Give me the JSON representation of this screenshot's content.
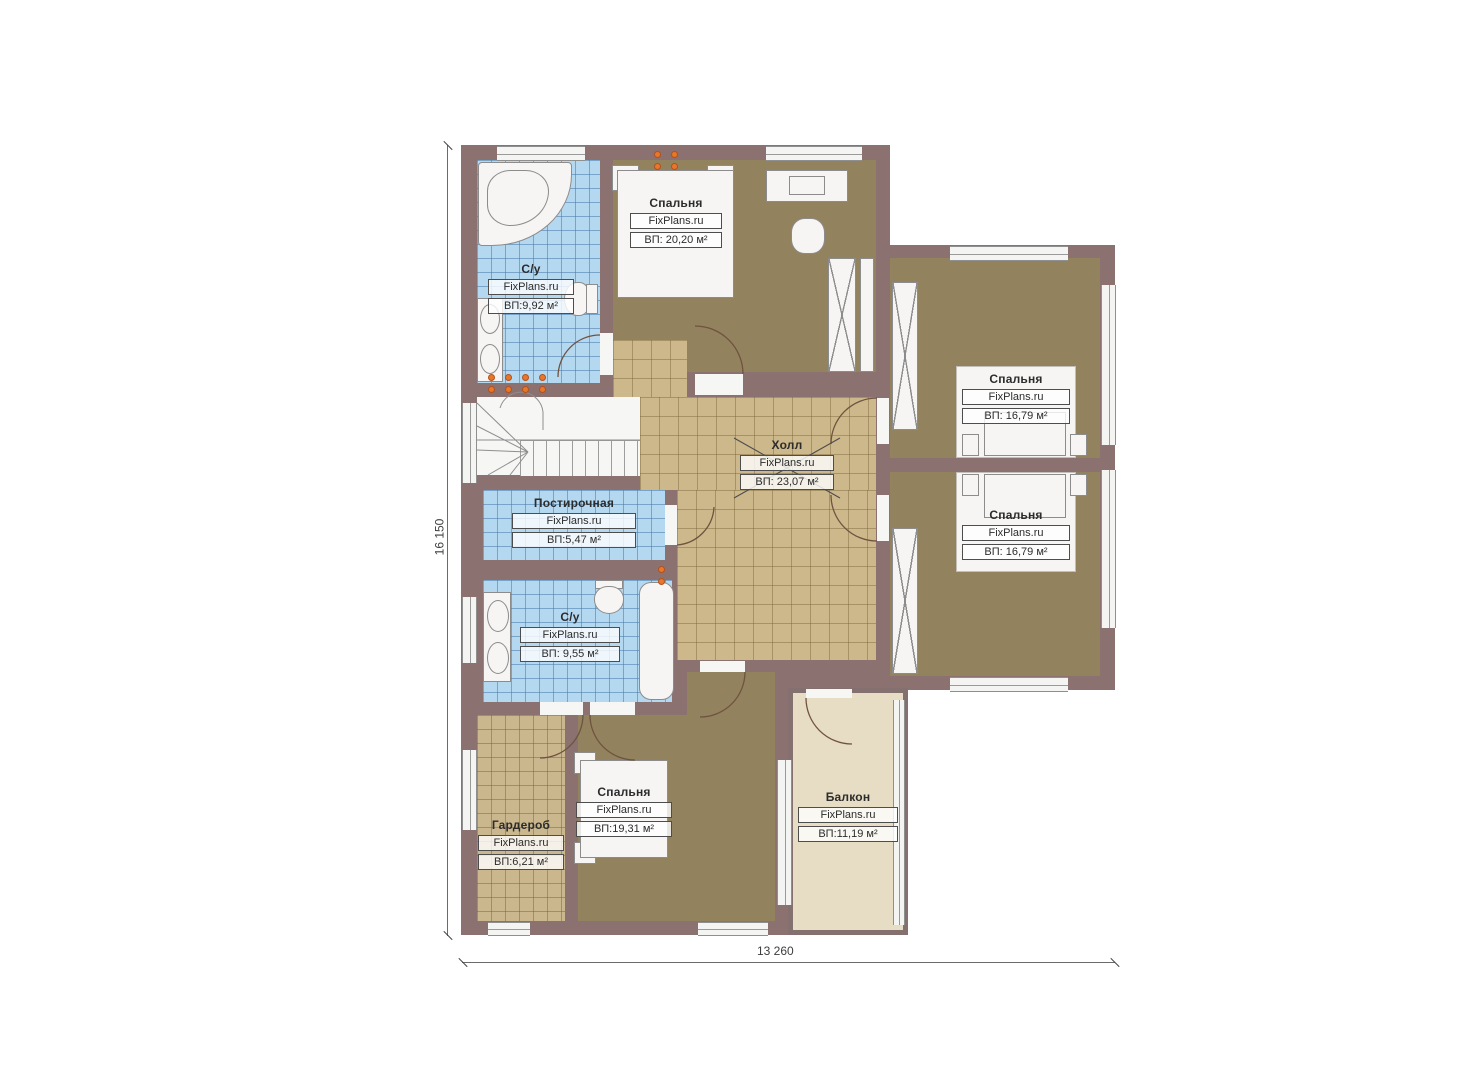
{
  "watermark": "FixPlans.ru",
  "dimensions": {
    "bottom": "13 260",
    "left": "16 150"
  },
  "rooms": [
    {
      "key": "bathroom-top",
      "name": "С/у",
      "watermark": "FixPlans.ru",
      "area": "ВП:9,92 м²"
    },
    {
      "key": "bedroom-top",
      "name": "Спальня",
      "watermark": "FixPlans.ru",
      "area": "ВП: 20,20 м²"
    },
    {
      "key": "hall",
      "name": "Холл",
      "watermark": "FixPlans.ru",
      "area": "ВП: 23,07 м²"
    },
    {
      "key": "bedroom-right-top",
      "name": "Спальня",
      "watermark": "FixPlans.ru",
      "area": "ВП: 16,79 м²"
    },
    {
      "key": "bedroom-right-bottom",
      "name": "Спальня",
      "watermark": "FixPlans.ru",
      "area": "ВП: 16,79 м²"
    },
    {
      "key": "laundry",
      "name": "Постирочная",
      "watermark": "FixPlans.ru",
      "area": "ВП:5,47 м²"
    },
    {
      "key": "bathroom-bottom",
      "name": "С/у",
      "watermark": "FixPlans.ru",
      "area": "ВП: 9,55 м²"
    },
    {
      "key": "wardrobe",
      "name": "Гардероб",
      "watermark": "FixPlans.ru",
      "area": "ВП:6,21 м²"
    },
    {
      "key": "bedroom-bottom",
      "name": "Спальня",
      "watermark": "FixPlans.ru",
      "area": "ВП:19,31 м²"
    },
    {
      "key": "balcony",
      "name": "Балкон",
      "watermark": "FixPlans.ru",
      "area": "ВП:11,19 м²"
    }
  ],
  "colors": {
    "wall": "#8b7170",
    "floor_bedroom": "#93825e",
    "floor_hall": "#ccb88b",
    "floor_wet": "#b5d8f1",
    "floor_balcony": "#e7dcc4",
    "radiator": "#e8772b"
  }
}
